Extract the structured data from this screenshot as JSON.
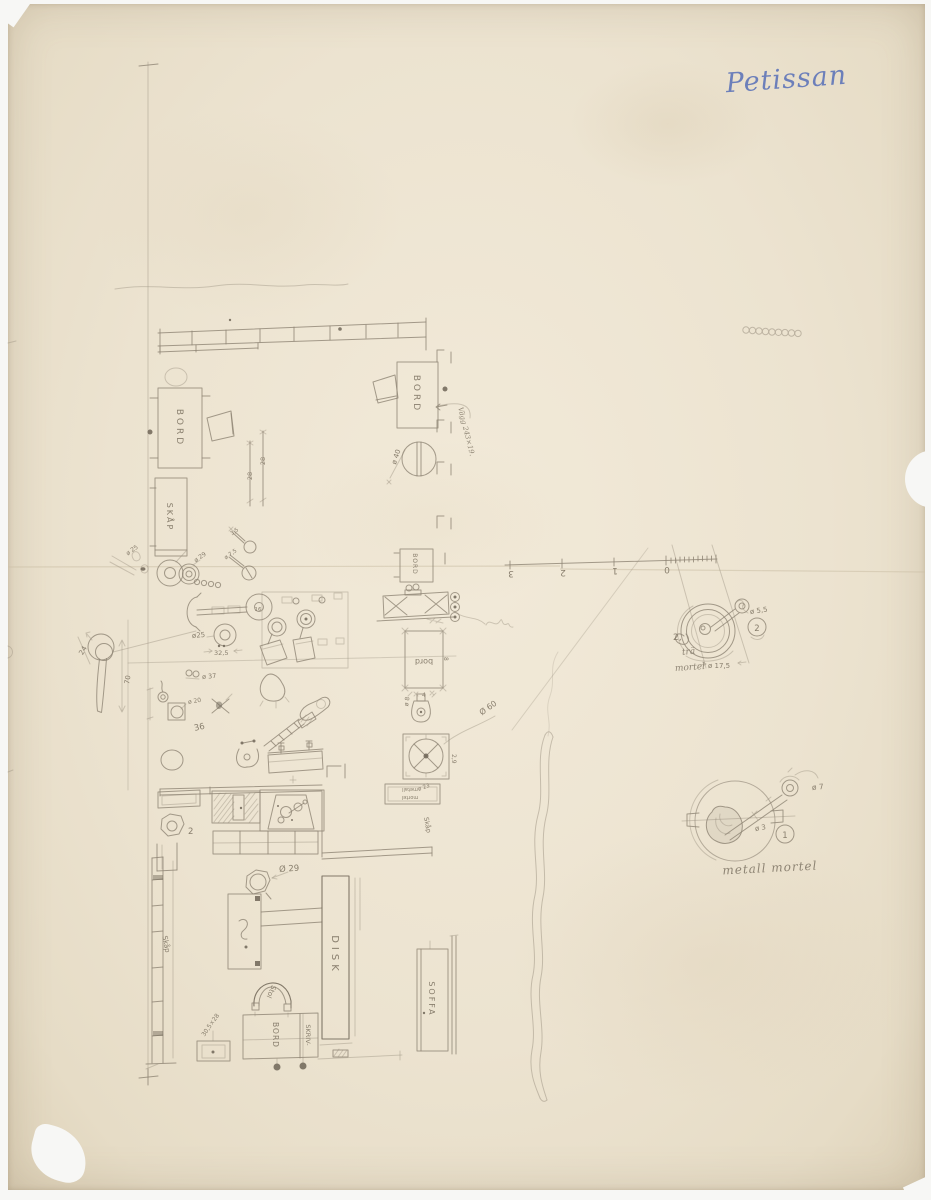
{
  "ink": {
    "title": "Petissan"
  },
  "colors": {
    "paper": "#ece3d0",
    "pencil": "#8e8474",
    "ink_blue": "#5b72b8"
  },
  "furniture": {
    "bord_left": "BORD",
    "skap_upper": "SKÅP",
    "bord_right": "BORD",
    "bord_square": "BORD",
    "bord_lower": "bord",
    "disk": "DISK",
    "stol": "Stol",
    "skriv": "SKRIV-",
    "skriv_bord": "BORD",
    "soffa": "SOFFA",
    "skap_ladder": "Skåp",
    "skap_mid": "Skåp"
  },
  "mortars": {
    "tra_line1": "trä",
    "tra_line2": "mortel",
    "tra_dia_pestle": "ø 5,5",
    "tra_dia": "ø 17,5",
    "tra_no": "2",
    "tra_ref": "2,",
    "metall_caption": "metall mortel",
    "metall_dia_knob": "ø 7",
    "metall_dia_shaft": "ø 3",
    "metall_no": "1",
    "box_line1": "metall",
    "box_line2": "mortel",
    "box_dia": "ø 23"
  },
  "dims": {
    "d28a": "28",
    "d28b": "28",
    "d24": "24",
    "d70": "70",
    "dia25_left": "ø 25",
    "dia29_small": "ø 29",
    "dia25": "ø25",
    "d325": "32,5",
    "dia20": "ø 20",
    "n36": "36",
    "dia37": "ø 37",
    "dia29_oct": "Ø 29",
    "dia40": "ø 40",
    "dia60": "Ø 60",
    "dia8": "ø 8",
    "d4": "4",
    "d29": "2,9",
    "dia75": "ø 7,5",
    "d35": "3,5",
    "n16": "16",
    "n2": "2",
    "n8": "8",
    "box_dim": "30,5×28",
    "wall_note": "Vägg 243×19."
  },
  "scale": {
    "t3": "3",
    "t2": "2",
    "t1": "1",
    "t0": "0"
  }
}
